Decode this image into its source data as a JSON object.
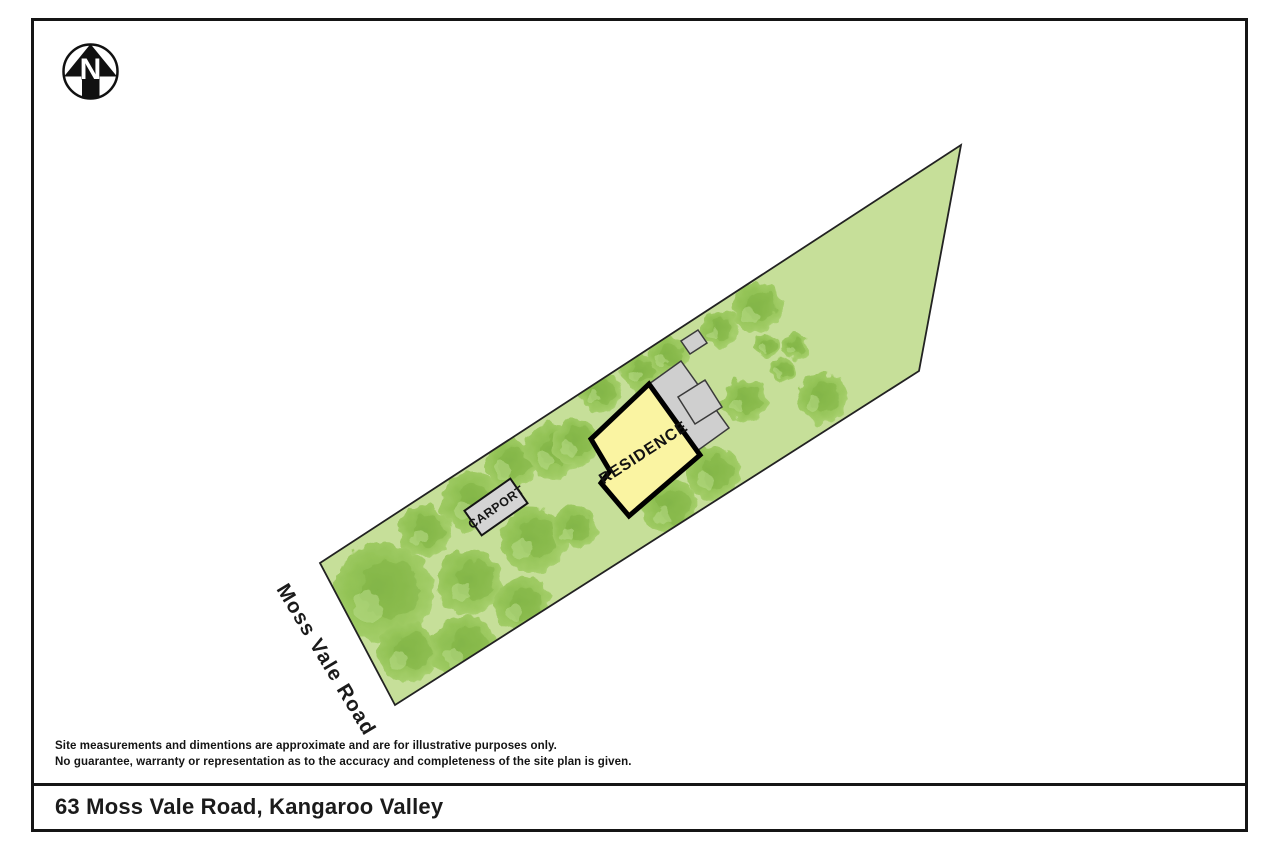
{
  "page": {
    "title": "63 Moss Vale Road, Kangaroo Valley",
    "disclaimer": {
      "line1": "Site measurements and dimentions are approximate and are for illustrative purposes only.",
      "line2": "No guarantee, warranty or representation as to the accuracy and completeness of the site plan is given."
    }
  },
  "plan": {
    "north_label": "N",
    "road_label": "Moss Vale Road",
    "residence_label": "RESIDENCE",
    "carport_label": "CARPORT",
    "colors": {
      "parcel_fill": "#C6DF99",
      "parcel_stroke": "#222222",
      "tree_green_mid": "#98C75C",
      "tree_green_dark": "#7EB243",
      "tree_green_light": "#B9DD8A",
      "residence_fill": "#FAF4A2",
      "residence_stroke": "#000000",
      "structure_gray": "#D2D2D2",
      "ink": "#151515"
    },
    "parcel_points": "320,563 961,145 919,371 395,705",
    "residence_points": "649,384 700,455 629,516 601,483 610,471 591,439",
    "outbuilding_main_points": "649,384 697,451 729,428 681,361",
    "outbuilding_square_points": "705,380 722,407 695,424 678,397",
    "shed_points": "698,330 707,343 690,354 681,341",
    "trees": [
      {
        "cx": 383,
        "cy": 592,
        "r": 50
      },
      {
        "cx": 425,
        "cy": 531,
        "r": 26
      },
      {
        "cx": 472,
        "cy": 502,
        "r": 30
      },
      {
        "cx": 511,
        "cy": 463,
        "r": 26
      },
      {
        "cx": 553,
        "cy": 451,
        "r": 28
      },
      {
        "cx": 533,
        "cy": 540,
        "r": 33
      },
      {
        "cx": 470,
        "cy": 582,
        "r": 33
      },
      {
        "cx": 408,
        "cy": 652,
        "r": 30
      },
      {
        "cx": 464,
        "cy": 648,
        "r": 33
      },
      {
        "cx": 522,
        "cy": 605,
        "r": 28
      },
      {
        "cx": 575,
        "cy": 528,
        "r": 22
      },
      {
        "cx": 576,
        "cy": 442,
        "r": 24
      },
      {
        "cx": 600,
        "cy": 392,
        "r": 21
      },
      {
        "cx": 640,
        "cy": 372,
        "r": 19
      },
      {
        "cx": 668,
        "cy": 356,
        "r": 20
      },
      {
        "cx": 719,
        "cy": 329,
        "r": 19
      },
      {
        "cx": 757,
        "cy": 308,
        "r": 25
      },
      {
        "cx": 767,
        "cy": 346,
        "r": 12
      },
      {
        "cx": 795,
        "cy": 346,
        "r": 13
      },
      {
        "cx": 783,
        "cy": 370,
        "r": 12
      },
      {
        "cx": 822,
        "cy": 398,
        "r": 25
      },
      {
        "cx": 745,
        "cy": 400,
        "r": 22
      },
      {
        "cx": 670,
        "cy": 507,
        "r": 28
      },
      {
        "cx": 713,
        "cy": 473,
        "r": 27
      }
    ]
  }
}
